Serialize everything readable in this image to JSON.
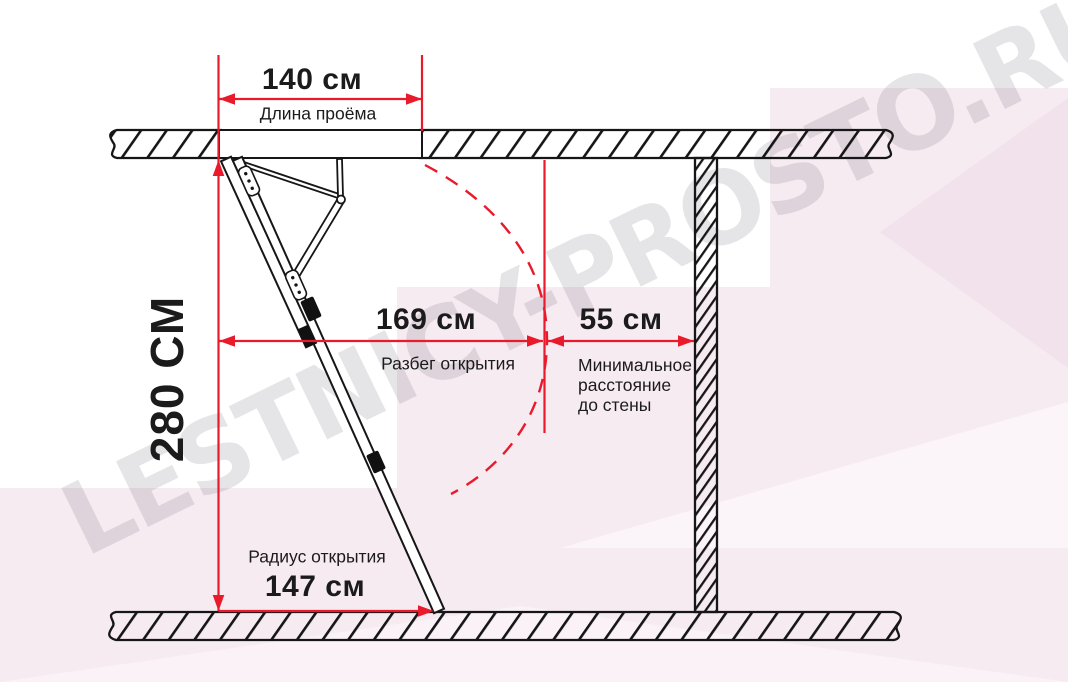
{
  "watermark": "LESTNICY-PROSTO.RU",
  "colors": {
    "red": "#e81a2b",
    "ink": "#1b1b1b",
    "pink": "#f7ebf2",
    "wm_gray": "rgba(98,92,104,0.17)"
  },
  "dims": {
    "opening": {
      "value": "140 см",
      "label": "Длина проёма"
    },
    "height": {
      "value": "280 СМ"
    },
    "run": {
      "value": "169 см",
      "label": "Разбег открытия"
    },
    "wall_clearance": {
      "value": "55 см",
      "label_line1": "Минимальное",
      "label_line2": "расстояние",
      "label_line3": "до стены"
    },
    "radius": {
      "value": "147 см",
      "label": "Радиус открытия"
    }
  }
}
